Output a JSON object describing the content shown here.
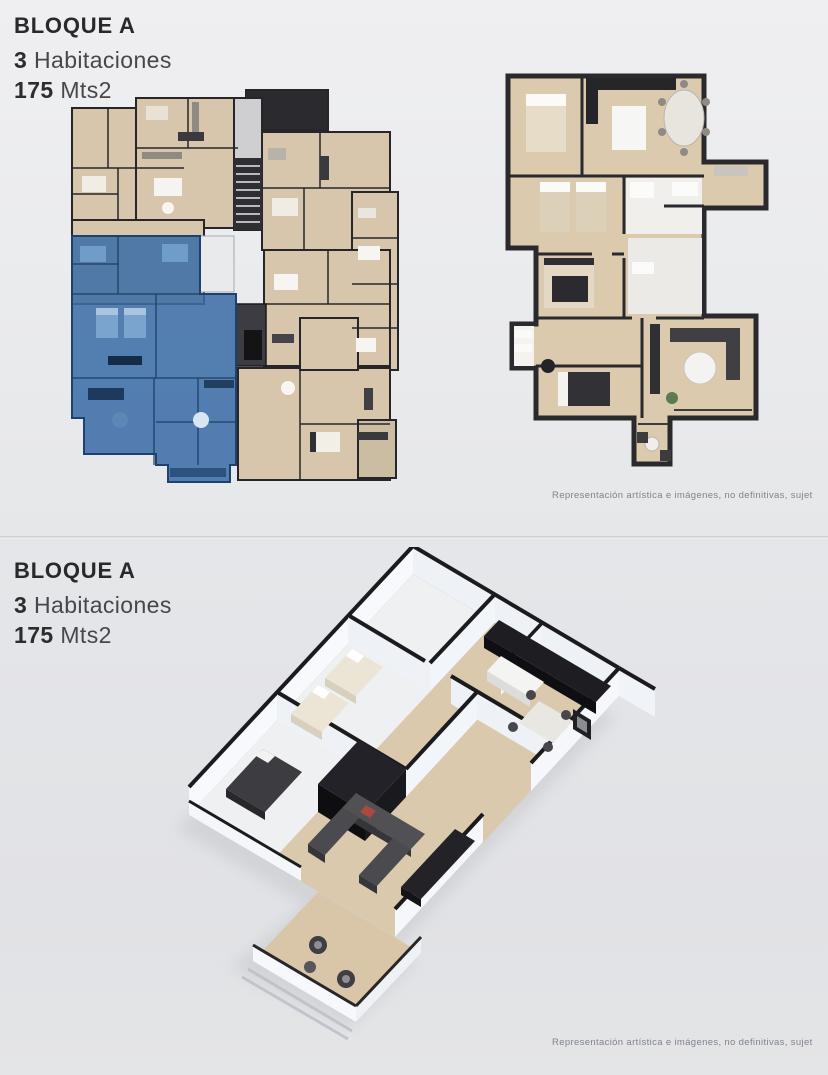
{
  "panels": [
    {
      "header": {
        "block_title": "BLOQUE A",
        "bedrooms_value": "3",
        "bedrooms_label": "Habitaciones",
        "area_value": "175",
        "area_label": "Mts2"
      },
      "disclaimer": "Representación artística e imágenes, no definitivas, sujet"
    },
    {
      "header": {
        "block_title": "BLOQUE A",
        "bedrooms_value": "3",
        "bedrooms_label": "Habitaciones",
        "area_value": "175",
        "area_label": "Mts2"
      },
      "disclaimer": "Representación artística e imágenes, no definitivas, sujet"
    }
  ],
  "colors": {
    "highlight_blue": "#3d6da6",
    "floor_tan": "#d7c6ac",
    "wall_dark": "#26262a",
    "background_top": "#ebecee",
    "background_bottom": "#e2e3e6",
    "disclaimer_gray": "#7e838d"
  }
}
